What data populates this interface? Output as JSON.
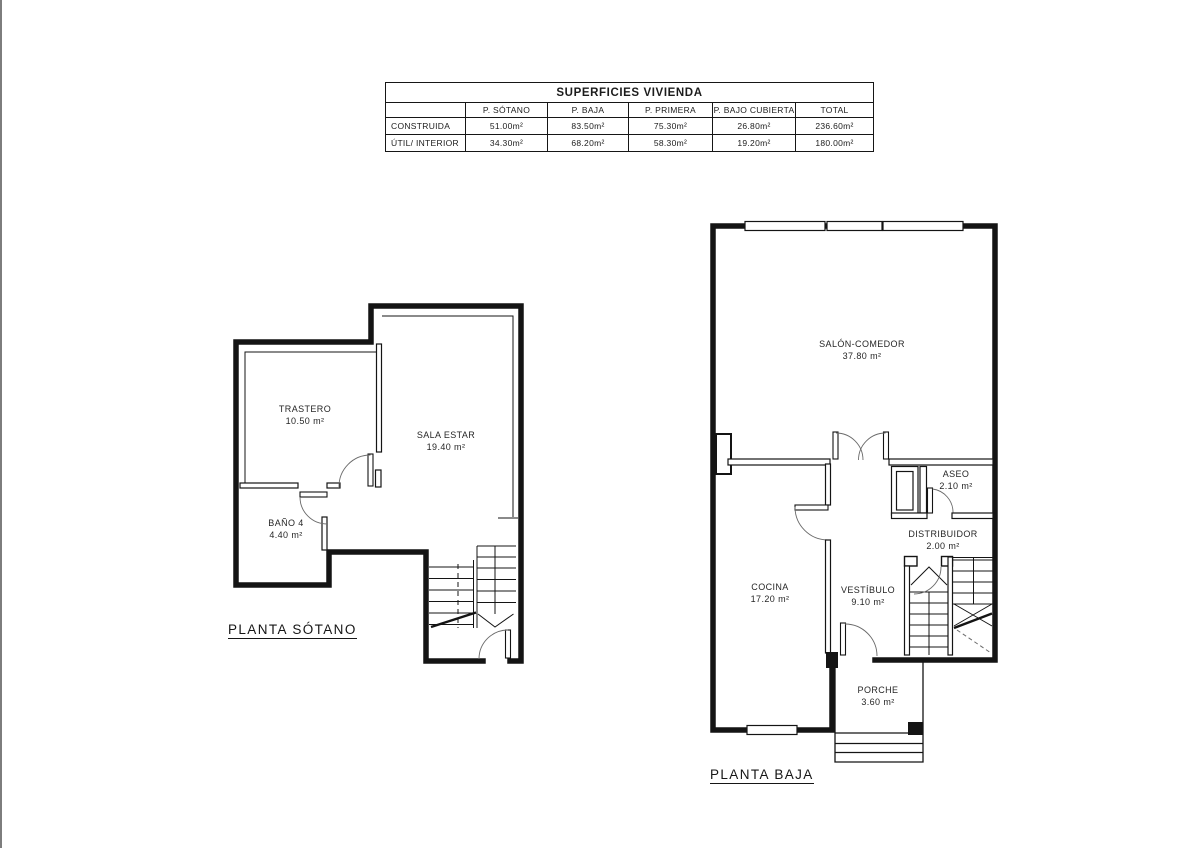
{
  "table": {
    "title": "SUPERFICIES VIVIENDA",
    "columns": [
      "",
      "P. SÓTANO",
      "P. BAJA",
      "P. PRIMERA",
      "P. BAJO CUBIERTA",
      "TOTAL"
    ],
    "rows": [
      {
        "label": "CONSTRUIDA",
        "values": [
          "51.00m²",
          "83.50m²",
          "75.30m²",
          "26.80m²",
          "236.60m²"
        ]
      },
      {
        "label": "ÚTIL/ INTERIOR",
        "values": [
          "34.30m²",
          "68.20m²",
          "58.30m²",
          "19.20m²",
          "180.00m²"
        ]
      }
    ]
  },
  "plans": [
    {
      "title": "PLANTA SÓTANO",
      "rooms": [
        {
          "name": "TRASTERO",
          "area": "10.50 m²"
        },
        {
          "name": "SALA ESTAR",
          "area": "19.40 m²"
        },
        {
          "name": "BAÑO 4",
          "area": "4.40 m²"
        }
      ]
    },
    {
      "title": "PLANTA BAJA",
      "rooms": [
        {
          "name": "SALÓN-COMEDOR",
          "area": "37.80 m²"
        },
        {
          "name": "ASEO",
          "area": "2.10 m²"
        },
        {
          "name": "DISTRIBUIDOR",
          "area": "2.00 m²"
        },
        {
          "name": "COCINA",
          "area": "17.20 m²"
        },
        {
          "name": "VESTÍBULO",
          "area": "9.10 m²"
        },
        {
          "name": "PORCHE",
          "area": "3.60 m²"
        }
      ]
    }
  ],
  "colors": {
    "line": "#141414",
    "arc": "#6a6a6a",
    "paper": "#ffffff",
    "edge": "#7d7d7d"
  }
}
